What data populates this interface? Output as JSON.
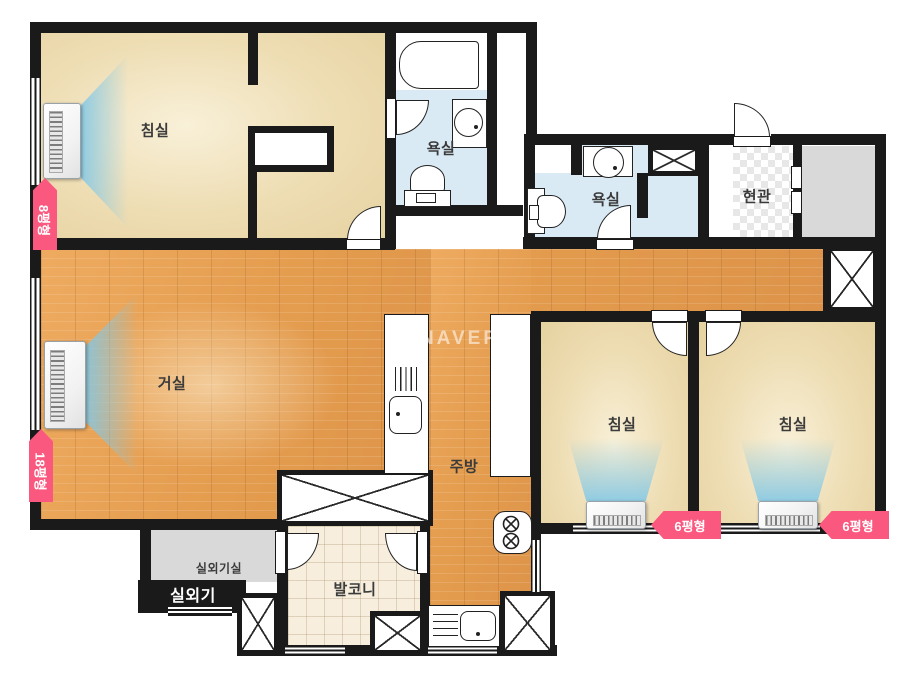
{
  "watermark": "NAVER",
  "rooms": {
    "bedroom_main": {
      "label": "침실"
    },
    "bath1": {
      "label": "욕실"
    },
    "bath2": {
      "label": "욕실"
    },
    "entrance": {
      "label": "현관"
    },
    "living": {
      "label": "거실"
    },
    "kitchen": {
      "label": "주방"
    },
    "bedroom2": {
      "label": "침실"
    },
    "bedroom3": {
      "label": "침실"
    },
    "balcony": {
      "label": "발코니"
    },
    "ac_unit_room": {
      "label": "실외기실"
    },
    "outdoor_unit": {
      "label": "실외기"
    }
  },
  "ac_badges": {
    "bedroom_main": "8평형",
    "living": "18평형",
    "bedroom2": "6평형",
    "bedroom3": "6평형"
  },
  "colors": {
    "wall": "#1a1a1a",
    "badge_pink": "#fa587e",
    "bedroom_tan": "#eeddb3",
    "bath_blue": "#d9eaf5",
    "wood_floor": "#e49c4e",
    "balcony_beige": "#f7eedd",
    "gray_room": "#d9d9d9",
    "air_flow_blue": "#80c8e9"
  }
}
